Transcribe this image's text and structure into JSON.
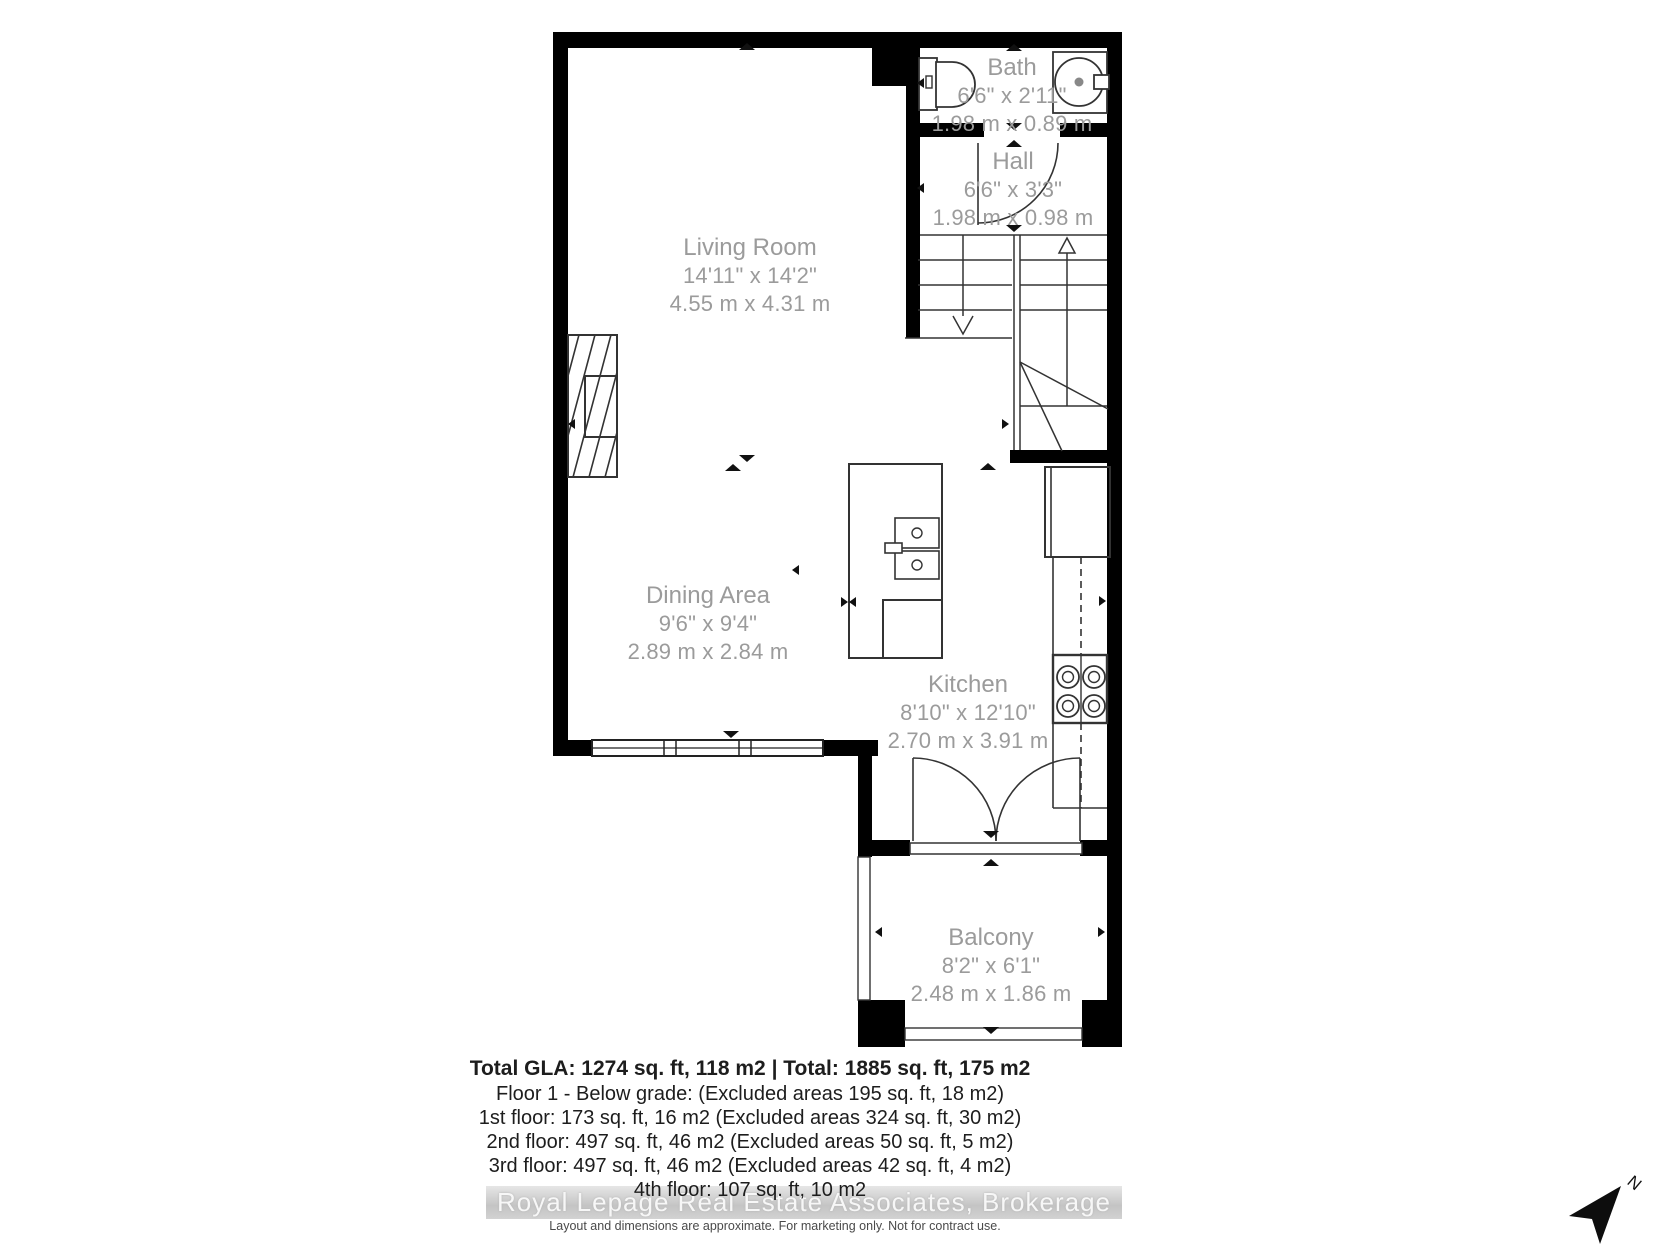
{
  "rooms": [
    {
      "name": "Living Room",
      "imperial": "14'11\" x 14'2\"",
      "metric": "4.55 m x 4.31 m"
    },
    {
      "name": "Dining Area",
      "imperial": "9'6\" x 9'4\"",
      "metric": "2.89 m x 2.84 m"
    },
    {
      "name": "Kitchen",
      "imperial": "8'10\" x 12'10\"",
      "metric": "2.70 m x 3.91 m"
    },
    {
      "name": "Balcony",
      "imperial": "8'2\" x 6'1\"",
      "metric": "2.48 m x 1.86 m"
    },
    {
      "name": "Bath",
      "imperial": "6'6\" x 2'11\"",
      "metric": "1.98 m x 0.89 m"
    },
    {
      "name": "Hall",
      "imperial": "6'6\" x 3'3\"",
      "metric": "1.98 m x 0.98 m"
    }
  ],
  "summary": {
    "total": "Total GLA: 1274 sq. ft, 118 m2 | Total: 1885 sq. ft, 175 m2",
    "lines": [
      "Floor 1 - Below grade: (Excluded areas 195 sq. ft, 18 m2)",
      "1st floor: 173 sq. ft, 16 m2 (Excluded areas 324 sq. ft, 30 m2)",
      "2nd floor: 497 sq. ft, 46 m2 (Excluded areas 50 sq. ft, 5 m2)",
      "3rd floor: 497 sq. ft, 46 m2 (Excluded areas 42 sq. ft, 4 m2)",
      "4th floor: 107 sq. ft, 10 m2"
    ]
  },
  "watermark": "Royal Lepage Real Estate Associates, Brokerage",
  "disclaimer": "Layout and dimensions are approximate. For marketing only. Not for contract use.",
  "compass": {
    "label": "N"
  },
  "colors": {
    "wall": "#000000",
    "line": "#3a3a3a",
    "room_label": "#9b9b9b",
    "text": "#1d1d1d",
    "watermark_band": "#c9c9c9"
  }
}
